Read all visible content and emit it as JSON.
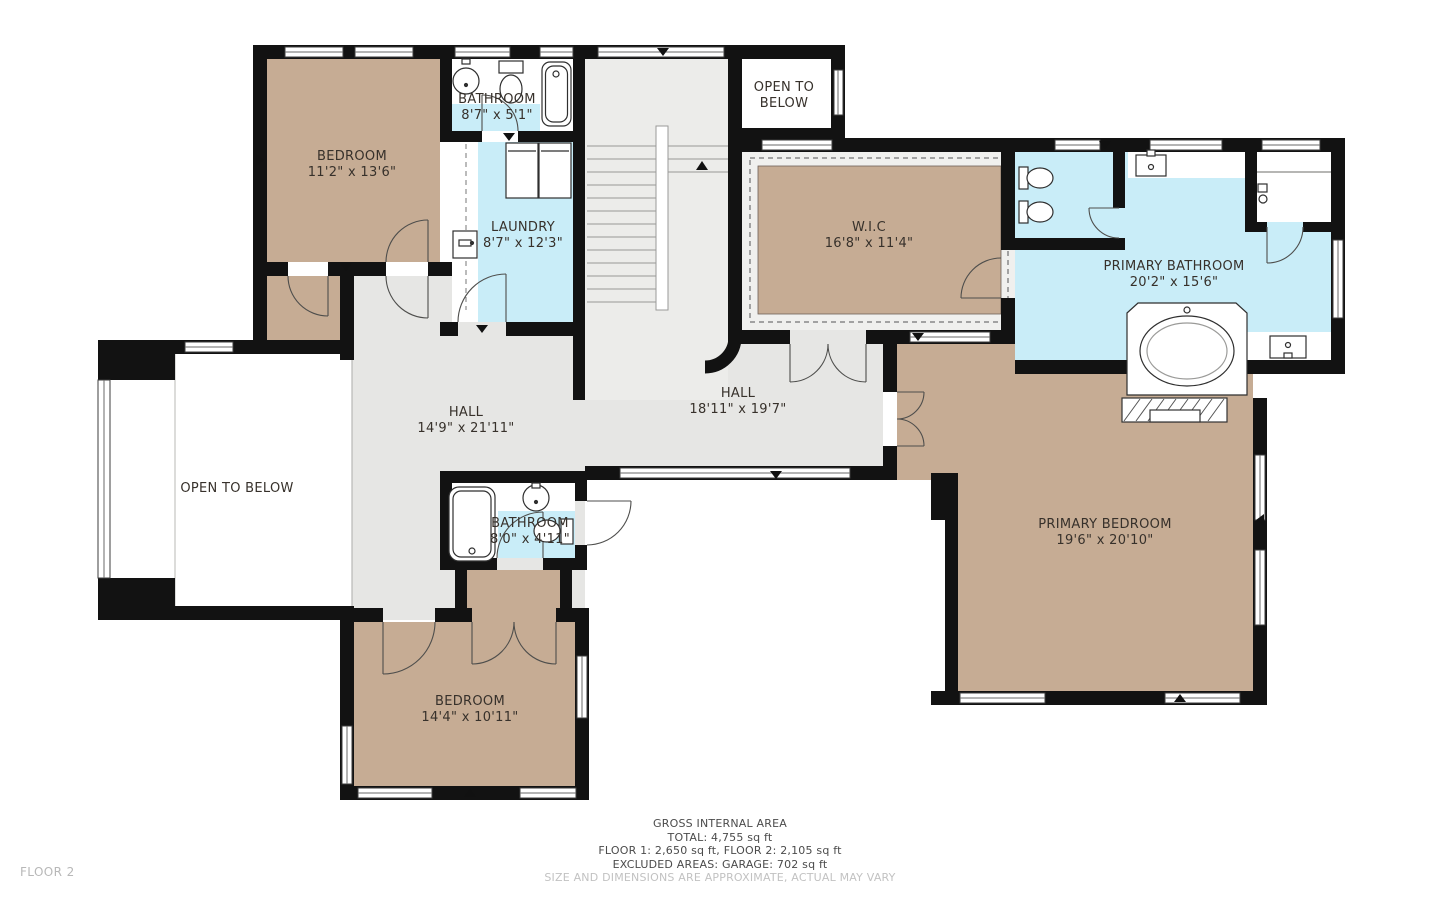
{
  "floor_label": "FLOOR 2",
  "rooms": [
    {
      "id": "bedroom-1",
      "name": "BEDROOM",
      "dims": "11'2\" x 13'6\""
    },
    {
      "id": "bathroom-1",
      "name": "BATHROOM",
      "dims": "8'7\" x 5'1\""
    },
    {
      "id": "laundry",
      "name": "LAUNDRY",
      "dims": "8'7\" x 12'3\""
    },
    {
      "id": "open-to-below-top",
      "name": "OPEN TO BELOW",
      "dims": ""
    },
    {
      "id": "walk-in-closet",
      "name": "W.I.C",
      "dims": "16'8\" x 11'4\""
    },
    {
      "id": "primary-bathroom",
      "name": "PRIMARY BATHROOM",
      "dims": "20'2\" x 15'6\""
    },
    {
      "id": "hall-west",
      "name": "HALL",
      "dims": "14'9\" x 21'11\""
    },
    {
      "id": "hall-east",
      "name": "HALL",
      "dims": "18'11\" x 19'7\""
    },
    {
      "id": "open-to-below-left",
      "name": "OPEN TO BELOW",
      "dims": ""
    },
    {
      "id": "bathroom-2",
      "name": "BATHROOM",
      "dims": "8'0\" x 4'11\""
    },
    {
      "id": "bedroom-2",
      "name": "BEDROOM",
      "dims": "14'4\" x 10'11\""
    },
    {
      "id": "primary-bedroom",
      "name": "PRIMARY BEDROOM",
      "dims": "19'6\" x 20'10\""
    }
  ],
  "footer": {
    "line1": "GROSS INTERNAL AREA",
    "line2": "TOTAL: 4,755 sq ft",
    "line3": "FLOOR 1: 2,650 sq ft, FLOOR 2: 2,105 sq ft",
    "line4": "EXCLUDED AREAS: GARAGE: 702 sq ft",
    "disclaimer": "SIZE AND DIMENSIONS ARE APPROXIMATE, ACTUAL MAY VARY"
  },
  "colors": {
    "wall": "#121212",
    "bedroom_fill": "#c6ac94",
    "bathroom_fill": "#c9edf8",
    "hall_fill": "#e6e6e4",
    "stairs_fill": "#ececea",
    "wic_margin": "#f0f0ee",
    "door_arc": "#4e4e4c",
    "label_text": "#37312b",
    "footer_text": "#4b4b4b",
    "muted_text": "#c2c2c2"
  },
  "fixtures": [
    "bathtub",
    "oval-bathtub",
    "sink",
    "toilet",
    "bidet",
    "shower",
    "washer",
    "dryer",
    "fireplace",
    "stairs"
  ]
}
